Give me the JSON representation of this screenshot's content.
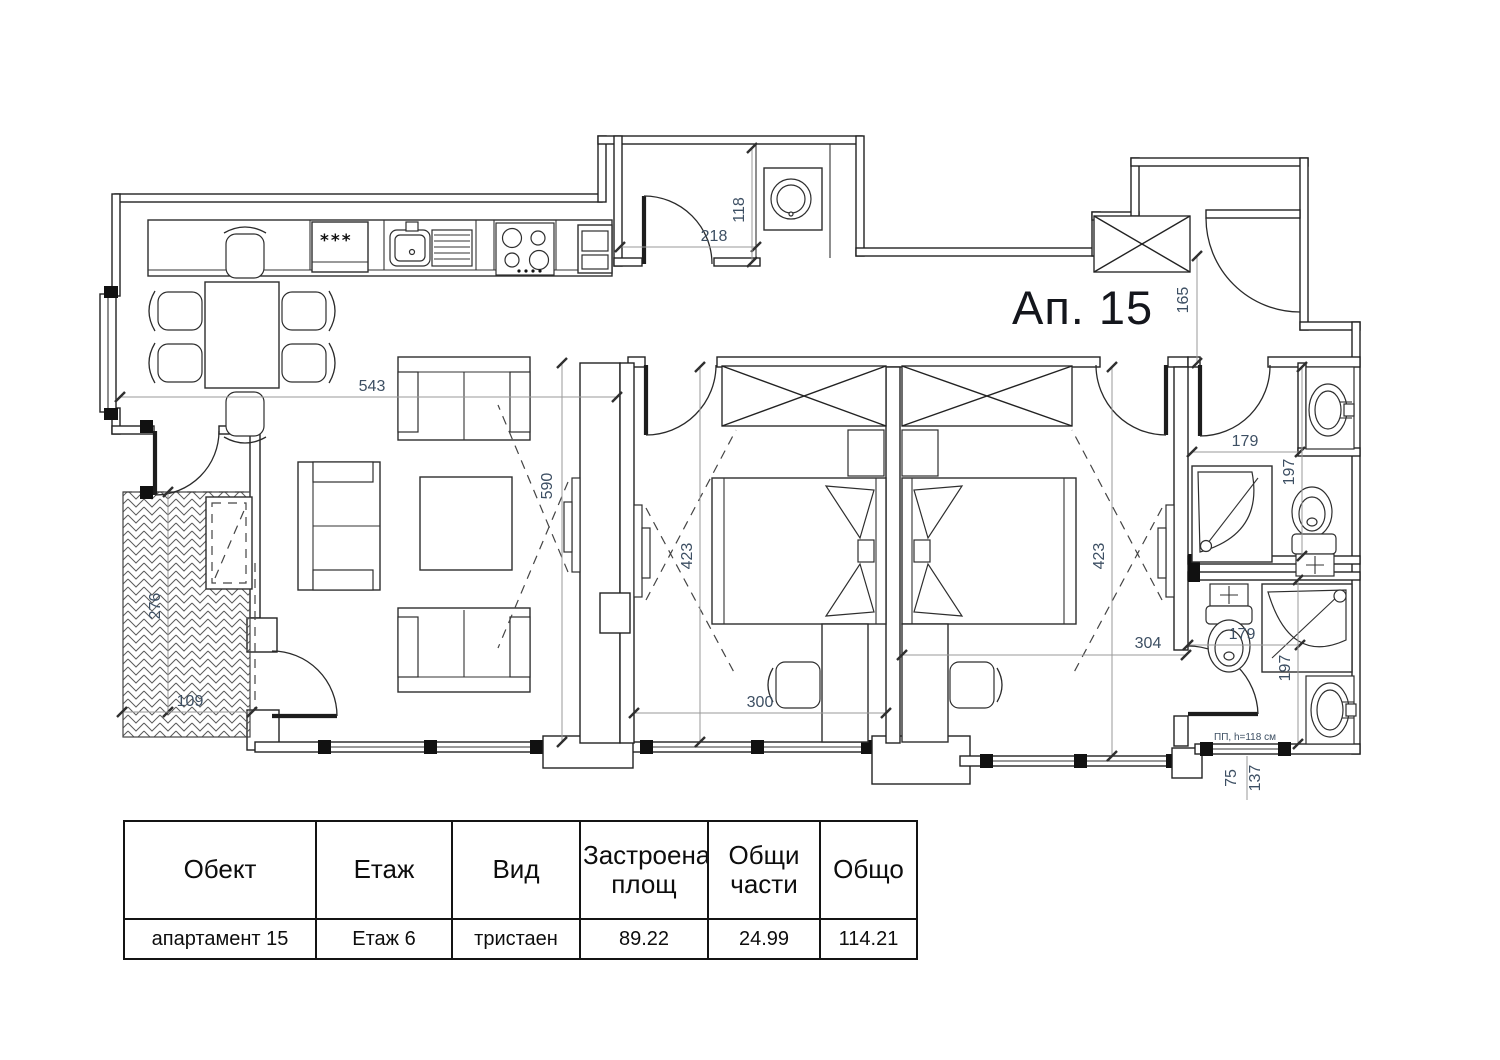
{
  "title": "Ап. 15",
  "plan": {
    "dims": {
      "d543": "543",
      "d590": "590",
      "d218": "218",
      "d118": "118",
      "d165": "165",
      "d423a": "423",
      "d423b": "423",
      "d300": "300",
      "d304": "304",
      "d179a": "179",
      "d197a": "197",
      "d179b": "179",
      "d197b": "197",
      "d276": "276",
      "d109": "109",
      "d75": "75",
      "d137": "137"
    },
    "labels": {
      "window_note": "ПП, h=118 см",
      "window_mark": "Пр.",
      "fridge_mark": "***"
    }
  },
  "table": {
    "headers": [
      "Обект",
      "Етаж",
      "Вид",
      "Застроена площ",
      "Общи части",
      "Общо"
    ],
    "row": [
      "апартамент 15",
      "Етаж 6",
      "тристаен",
      "89.22",
      "24.99",
      "114.21"
    ]
  },
  "colors": {
    "dimension_text": "#3d4f63",
    "line": "#222222",
    "background": "#ffffff"
  }
}
